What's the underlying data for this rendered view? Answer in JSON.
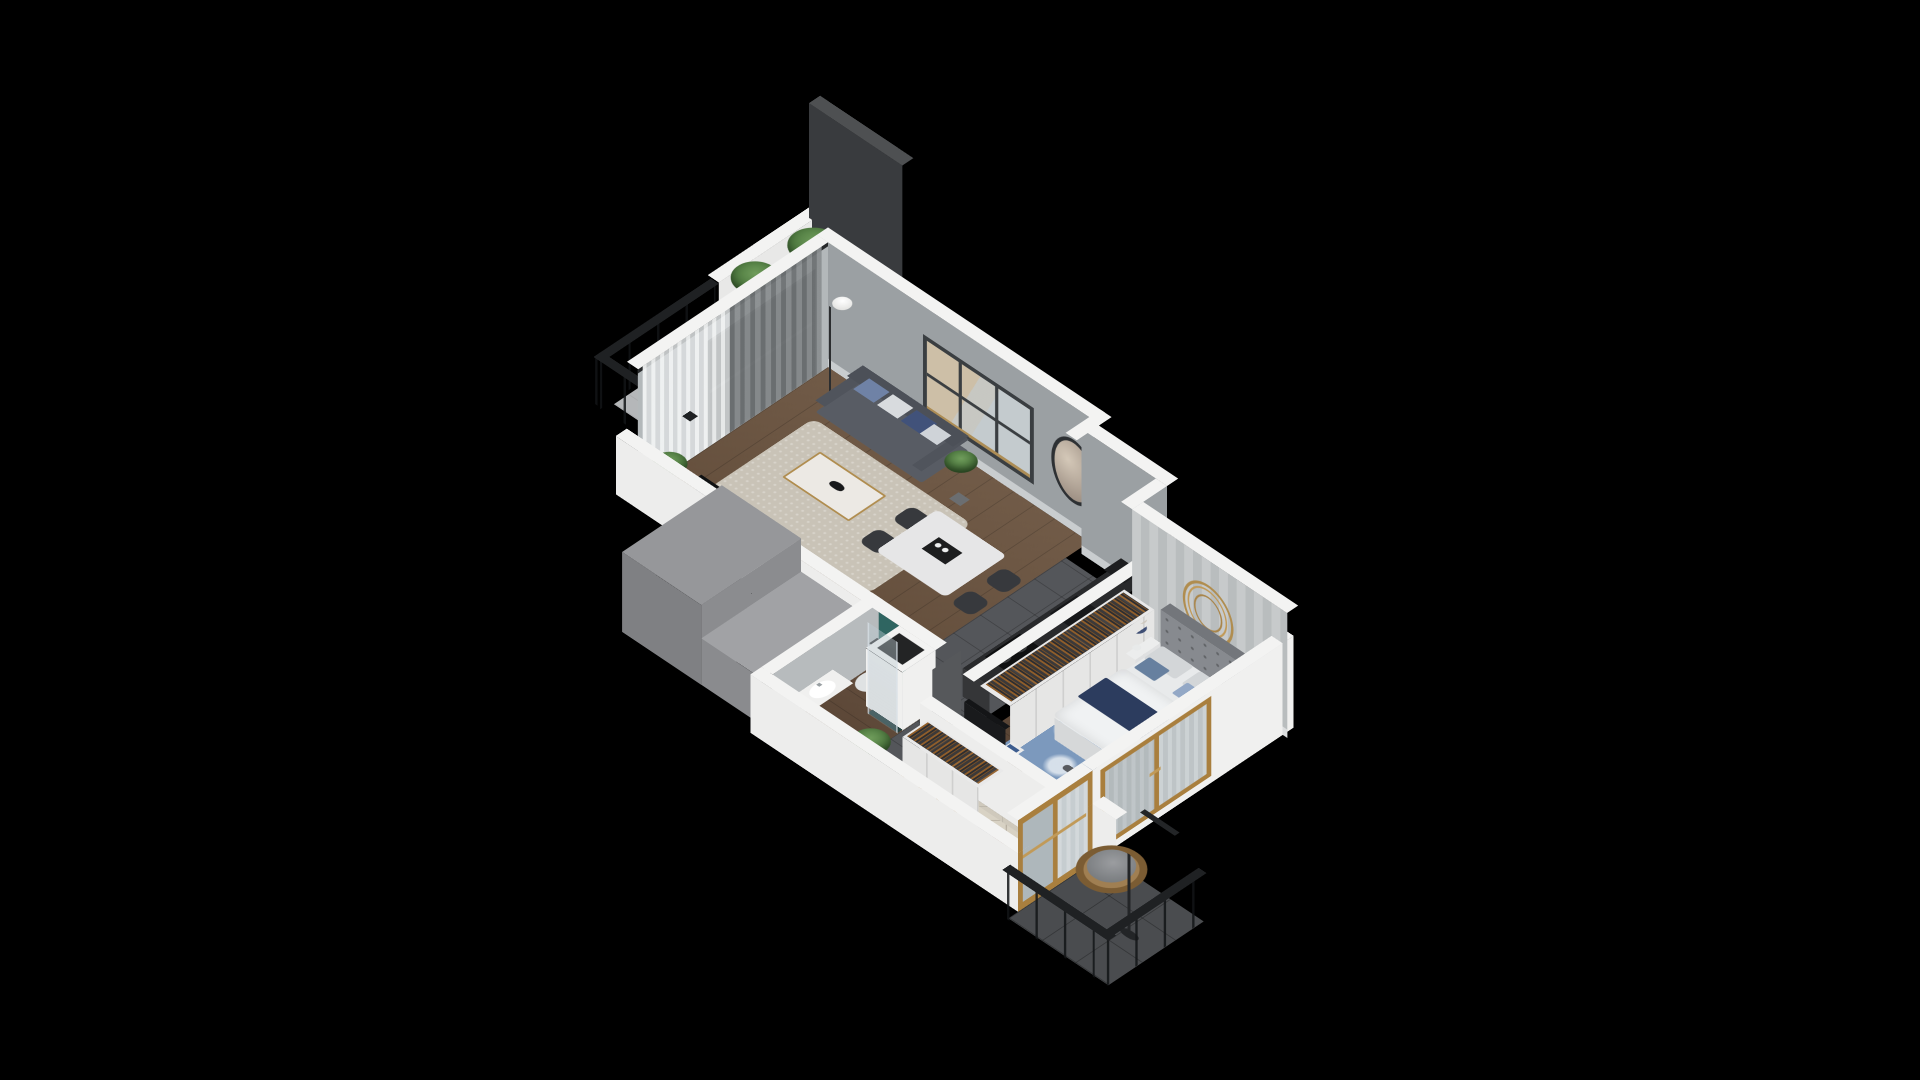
{
  "scene": {
    "type": "isometric-3d-floor-plan-render",
    "background": "#000000",
    "description": "cutaway 3d render of a one-bedroom apartment with two balconies, no visible text"
  },
  "palette": {
    "background": "#000000",
    "wall_top_white": "#f3f3f2",
    "wall_gray_interior": "#9ba0a3",
    "wall_light_gray": "#b7bbbd",
    "wallpaper_stripe": "#b9bdbe",
    "teal_accent": "#2f6561",
    "wood_floor_living": "#6b5440",
    "wood_floor_bedroom": "#5e4837",
    "kitchen_tile": "#54565a",
    "hall_tile": "#cfc9bc",
    "balcony_tile": "#4a4c4f",
    "counter_dark": "#292a2c",
    "sofa_gray": "#585c64",
    "marble_white": "#ece9e4",
    "gold_accent": "#b08d4f",
    "navy_textile": "#2c3c5e",
    "rug_blue": "#7c99bd",
    "rug_beige": "#c9c3b7",
    "plant_green": "#4e7a42",
    "oak_frame": "#a97f3e",
    "rattan_chair": "#a07f52",
    "glass_railing": "#aab9c2",
    "privacy_screen": "#393b3e"
  },
  "rooms": [
    {
      "name": "living-dining-room",
      "floor": "dark-wood",
      "furniture": [
        "gray-sofa-with-pillows",
        "marble-coffee-table",
        "beige-rug",
        "floor-lamp-globe",
        "tv-panel",
        "dining-table",
        "four-dark-chairs",
        "grid-window",
        "round-wall-mirror",
        "curtains-and-sheers",
        "potted-plants"
      ]
    },
    {
      "name": "kitchen",
      "floor": "dark-tile",
      "furniture": [
        "dark-counter",
        "induction-cooktop",
        "sink-with-faucet",
        "black-appliance"
      ]
    },
    {
      "name": "bedroom",
      "floor": "dark-wood",
      "furniture": [
        "double-bed-gray-headboard",
        "navy-throw",
        "blue-accent-pillows",
        "two-nightstands",
        "blue-table-lamps",
        "open-wardrobe-with-clothes",
        "blue-floral-rug",
        "white-desk",
        "desk-chair",
        "black-desk-lamp",
        "tv-on-cabinet",
        "bookshelf",
        "gold-wire-mirror",
        "oak-window"
      ]
    },
    {
      "name": "bathroom",
      "floor": "wood",
      "furniture": [
        "wall-hung-toilet",
        "teal-accent-wall",
        "sink-counter",
        "dark-shower",
        "service-shaft"
      ]
    },
    {
      "name": "entry-hall",
      "floor": "beige-tile",
      "furniture": [
        "open-wardrobe-with-clothes",
        "diamond-rug",
        "white-bench-with-pillows",
        "wooden-ladder-rack",
        "potted-plant",
        "gray-entry-door",
        "radiator"
      ]
    }
  ],
  "balconies": [
    {
      "name": "terrace-top",
      "items": [
        "white-parapet",
        "glass-railing-black-frame",
        "dark-privacy-screen",
        "green-bushes",
        "potted-plant",
        "gray-bench-cushion"
      ]
    },
    {
      "name": "balcony-bottom",
      "items": [
        "dark-tile-floor",
        "glass-railing-black-frame",
        "hanging-egg-chair-rattan",
        "gray-cushion",
        "oak-sliding-door"
      ]
    }
  ]
}
